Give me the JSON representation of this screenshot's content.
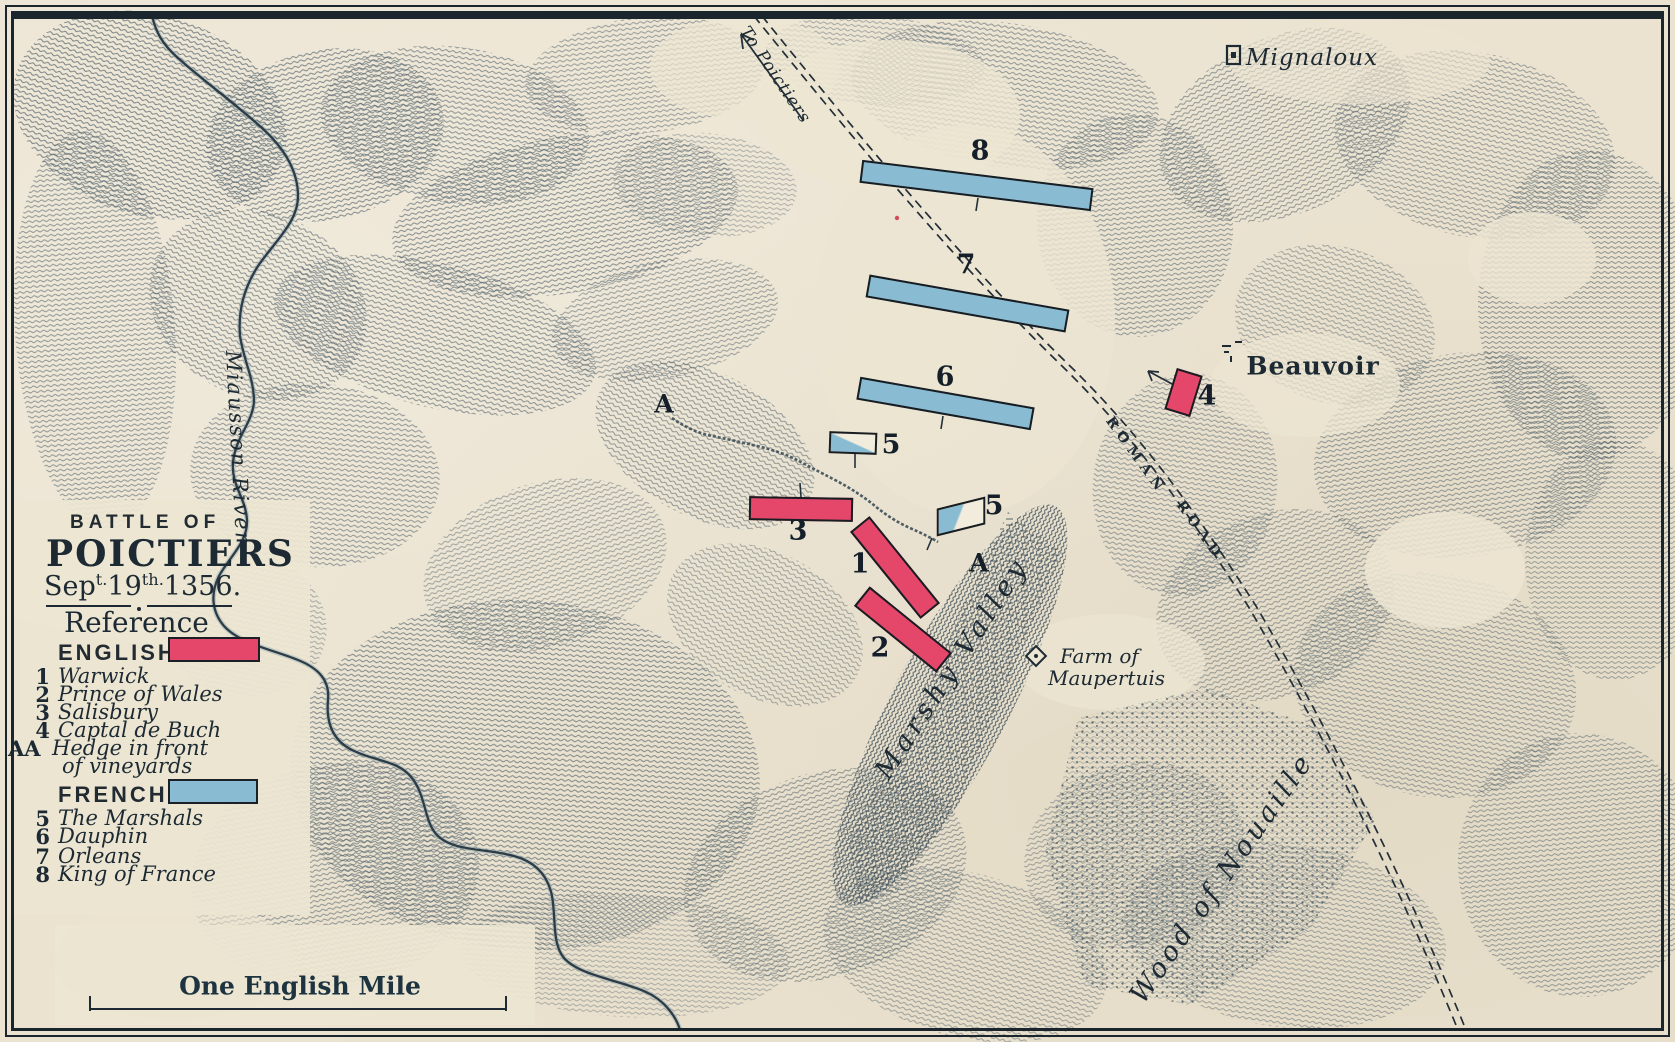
{
  "colors": {
    "paper": "#ebe3d0",
    "ink": "#1d2a33",
    "hachure": "#51616b",
    "english_red": "#e5476b",
    "french_blue": "#89bcd3",
    "river": "#2c3c47"
  },
  "title_block": {
    "line1": "BATTLE OF",
    "line2": "POICTIERS",
    "date_prefix": "Sep",
    "date_sup1": "t.",
    "date_num": "19",
    "date_sup2": "th.",
    "date_year": "1356.",
    "reference_heading": "Reference"
  },
  "legend": {
    "english_label": "ENGLISH",
    "english_items": [
      {
        "num": "1",
        "name": "Warwick"
      },
      {
        "num": "2",
        "name": "Prince of Wales"
      },
      {
        "num": "3",
        "name": "Salisbury"
      },
      {
        "num": "4",
        "name": "Captal de Buch"
      }
    ],
    "hedge_num": "AA",
    "hedge_line1": "Hedge in front",
    "hedge_line2": "of vineyards",
    "french_label": "FRENCH",
    "french_items": [
      {
        "num": "5",
        "name": "The Marshals"
      },
      {
        "num": "6",
        "name": "Dauphin"
      },
      {
        "num": "7",
        "name": "Orleans"
      },
      {
        "num": "8",
        "name": "King of France"
      }
    ]
  },
  "scale_label": "One English Mile",
  "labels": {
    "to_poictiers": "To Poictiers",
    "mignaloux": "Mignaloux",
    "beauvoir": "Beauvoir",
    "roman": "ROMAN",
    "road": "ROAD",
    "marshy_valley": "Marshy Valley",
    "farm_line1": "Farm of",
    "farm_line2": "Maupertuis",
    "wood": "Wood of Nouaille",
    "river": "Miausson River"
  },
  "unit_marks": {
    "n1": "1",
    "n2": "2",
    "n3": "3",
    "n4": "4",
    "n5a": "5",
    "n5b": "5",
    "n6": "6",
    "n7": "7",
    "n8": "8",
    "a1": "A",
    "a2": "A"
  }
}
